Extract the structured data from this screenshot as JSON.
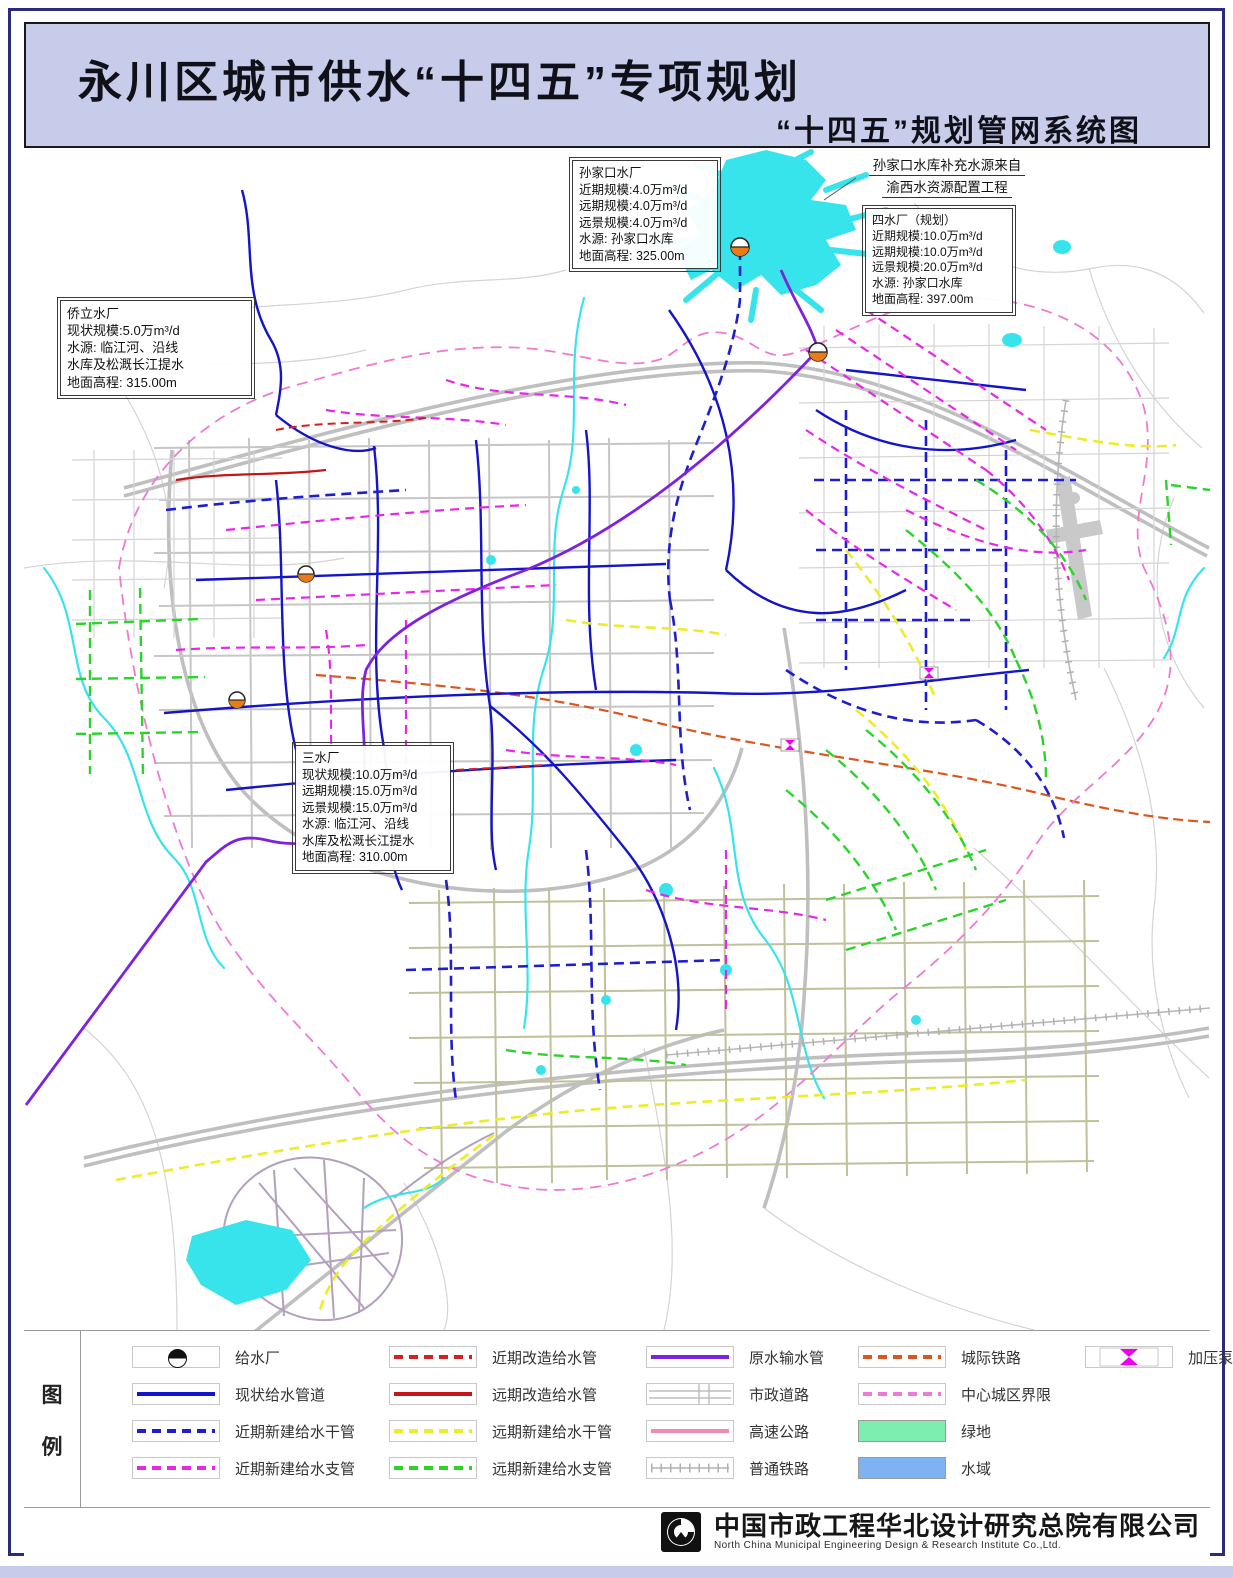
{
  "header": {
    "title": "永川区城市供水“十四五”专项规划",
    "subtitle": "“十四五”规划管网系统图"
  },
  "annotations": {
    "sunjiakou": {
      "lines": [
        "孙家口水厂",
        "近期规模:4.0万m³/d",
        "远期规模:4.0万m³/d",
        "远景规模:4.0万m³/d",
        "水源: 孙家口水库",
        "地面高程: 325.00m"
      ]
    },
    "sishuichang": {
      "lines": [
        "四水厂（规划）",
        "近期规模:10.0万m³/d",
        "远期规模:10.0万m³/d",
        "远景规模:20.0万m³/d",
        "水源: 孙家口水库",
        "地面高程: 397.00m"
      ]
    },
    "qiaoli": {
      "lines": [
        "侨立水厂",
        "现状规模:5.0万m³/d",
        "水源: 临江河、沿线",
        "水库及松溉长江提水",
        "地面高程: 315.00m"
      ]
    },
    "sanshuichang": {
      "lines": [
        "三水厂",
        "现状规模:10.0万m³/d",
        "远期规模:15.0万m³/d",
        "远景规模:15.0万m³/d",
        "水源: 临江河、沿线",
        "水库及松溉长江提水",
        "地面高程: 310.00m"
      ]
    },
    "note": {
      "lines": [
        "孙家口水库补充水源来自",
        "渝西水资源配置工程"
      ]
    }
  },
  "legend": {
    "panel_label_chars": [
      "图",
      "例"
    ],
    "items": [
      {
        "type": "plant-icon",
        "label": "给水厂"
      },
      {
        "type": "line",
        "style": "solid",
        "color": "#1414c8",
        "label": "现状给水管道"
      },
      {
        "type": "line",
        "style": "dashed",
        "color": "#1e1ecf",
        "label": "近期新建给水干管"
      },
      {
        "type": "line",
        "style": "dashed",
        "color": "#e826e8",
        "label": "近期新建给水支管"
      },
      {
        "type": "line",
        "style": "dashed",
        "color": "#d42020",
        "label": "近期改造给水管"
      },
      {
        "type": "line",
        "style": "solid",
        "color": "#c41616",
        "label": "远期改造给水管"
      },
      {
        "type": "line",
        "style": "dashed",
        "color": "#ecec2a",
        "label": "远期新建给水干管"
      },
      {
        "type": "line",
        "style": "dashed",
        "color": "#2bd42b",
        "label": "远期新建给水支管"
      },
      {
        "type": "line",
        "style": "solid",
        "color": "#7d22dd",
        "label": "原水输水管"
      },
      {
        "type": "road-icon",
        "label": "市政道路"
      },
      {
        "type": "line",
        "style": "solid",
        "color": "#f08bb4",
        "label": "高速公路"
      },
      {
        "type": "rail-icon",
        "label": "普通铁路"
      },
      {
        "type": "line",
        "style": "dashed",
        "color": "#d9571f",
        "label": "城际铁路"
      },
      {
        "type": "line",
        "style": "dashed",
        "color": "#ef7ad2",
        "label": "中心城区界限"
      },
      {
        "type": "fill",
        "color": "#7deead",
        "label": "绿地"
      },
      {
        "type": "fill",
        "color": "#7fb2f2",
        "label": "水域"
      },
      {
        "type": "pump-icon",
        "label": "加压泵站"
      }
    ]
  },
  "footer": {
    "company_cn": "中国市政工程华北设计研究总院有限公司",
    "company_en": "North China Municipal Engineering Design & Research Institute Co.,Ltd."
  },
  "colors": {
    "header_bg": "#c6cce9",
    "frame": "#2b2b7e",
    "water_cyan": "#38e4ec",
    "plant_orange": "#e87d18",
    "pump_magenta": "#ee00ee"
  }
}
